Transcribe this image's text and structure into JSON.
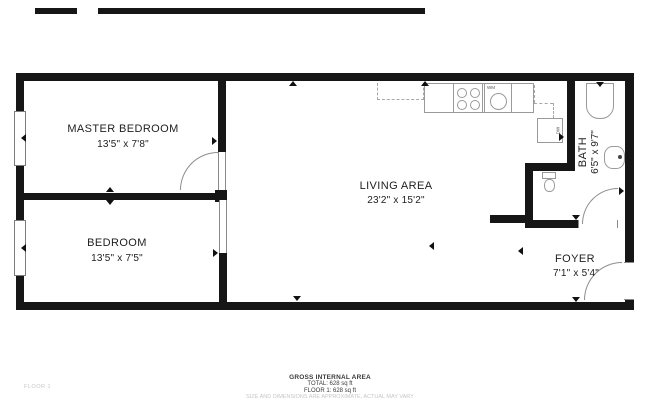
{
  "rooms": {
    "master": {
      "name": "MASTER BEDROOM",
      "dims": "13'5\" x 7'8\""
    },
    "bedroom": {
      "name": "BEDROOM",
      "dims": "13'5\" x 7'5\""
    },
    "living": {
      "name": "LIVING AREA",
      "dims": "23'2\" x 15'2\""
    },
    "bath": {
      "name": "BATH",
      "dims": "6'5\" x 9'7\""
    },
    "foyer": {
      "name": "FOYER",
      "dims": "7'1\" x 5'4\""
    }
  },
  "appliances": {
    "washing_machine": "WM",
    "dishwasher": "DW"
  },
  "footer": {
    "title": "GROSS INTERNAL AREA",
    "total": "TOTAL: 628 sq ft",
    "floor": "FLOOR 1: 628 sq ft",
    "disclaimer": "SIZE AND DIMENSIONS ARE APPROXIMATE, ACTUAL MAY VARY"
  },
  "floor_label": "FLOOR 1",
  "colors": {
    "wall": "#161616",
    "fixture_line": "#9a9a9a",
    "text": "#1e1e1e",
    "muted_text": "#c6c6c6"
  }
}
